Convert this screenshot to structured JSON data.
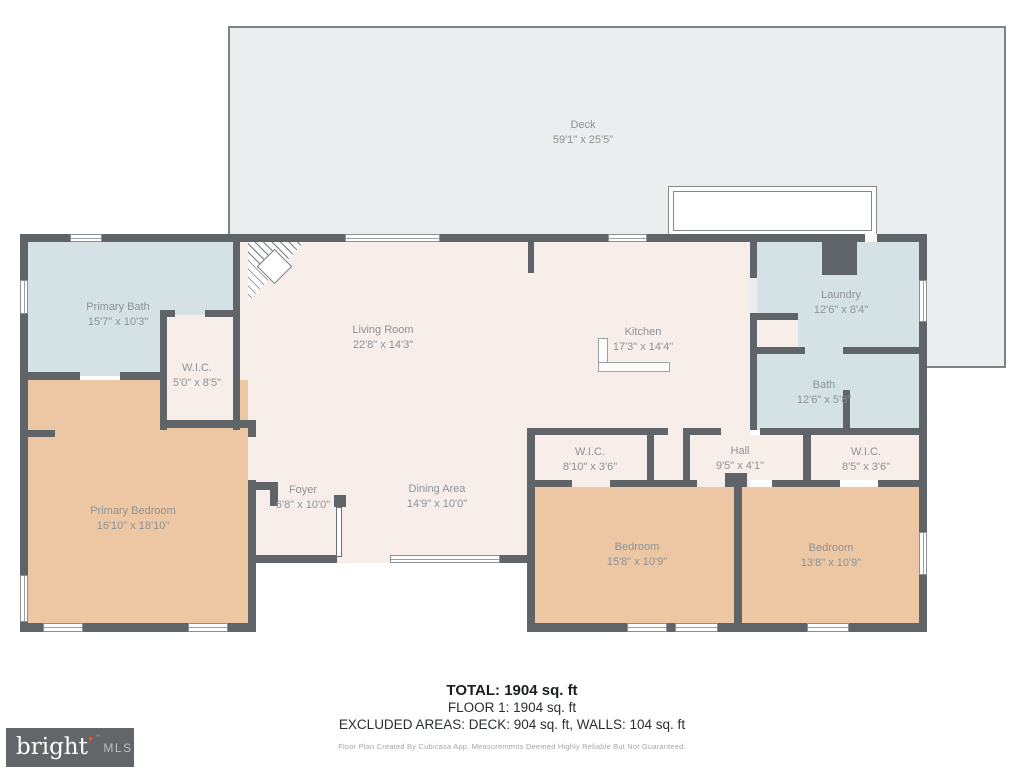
{
  "rooms": {
    "deck": {
      "name": "Deck",
      "dims": "59'1\" x 25'5\""
    },
    "primary_bath": {
      "name": "Primary Bath",
      "dims": "15'7\" x 10'3\""
    },
    "wic_primary": {
      "name": "W.I.C.",
      "dims": "5'0\" x 8'5\""
    },
    "living_room": {
      "name": "Living Room",
      "dims": "22'8\" x 14'3\""
    },
    "kitchen": {
      "name": "Kitchen",
      "dims": "17'3\" x 14'4\""
    },
    "laundry": {
      "name": "Laundry",
      "dims": "12'6\" x 8'4\""
    },
    "bath": {
      "name": "Bath",
      "dims": "12'6\" x 5'8\""
    },
    "primary_bedroom": {
      "name": "Primary Bedroom",
      "dims": "16'10\" x 18'10\""
    },
    "foyer": {
      "name": "Foyer",
      "dims": "6'8\" x 10'0\""
    },
    "dining": {
      "name": "Dining Area",
      "dims": "14'9\" x 10'0\""
    },
    "wic_left": {
      "name": "W.I.C.",
      "dims": "8'10\" x 3'6\""
    },
    "hall": {
      "name": "Hall",
      "dims": "9'5\" x 4'1\""
    },
    "wic_right": {
      "name": "W.I.C.",
      "dims": "8'5\" x 3'6\""
    },
    "bedroom_left": {
      "name": "Bedroom",
      "dims": "15'8\" x 10'9\""
    },
    "bedroom_right": {
      "name": "Bedroom",
      "dims": "13'8\" x 10'9\""
    }
  },
  "summary": {
    "total": "TOTAL: 1904 sq. ft",
    "floor": "FLOOR 1: 1904 sq. ft",
    "excluded": "EXCLUDED AREAS: DECK: 904 sq. ft, WALLS: 104 sq. ft",
    "disclaimer": "Floor Plan Created By Cubicasa App. Measurements Deemed Highly Reliable But Not Guaranteed."
  },
  "logo": {
    "brand": "bright",
    "star": "✦",
    "tm": "™",
    "mls": "MLS"
  },
  "colors": {
    "wall": "#5f6468",
    "deck_fill": "#ebedef",
    "wet_room_fill": "#d5e2e5",
    "bedroom_fill": "#edc7a4",
    "living_fill": "#f7eeea",
    "label_text": "#8d9296",
    "logo_background": "#626669",
    "logo_star": "#e4572e"
  }
}
